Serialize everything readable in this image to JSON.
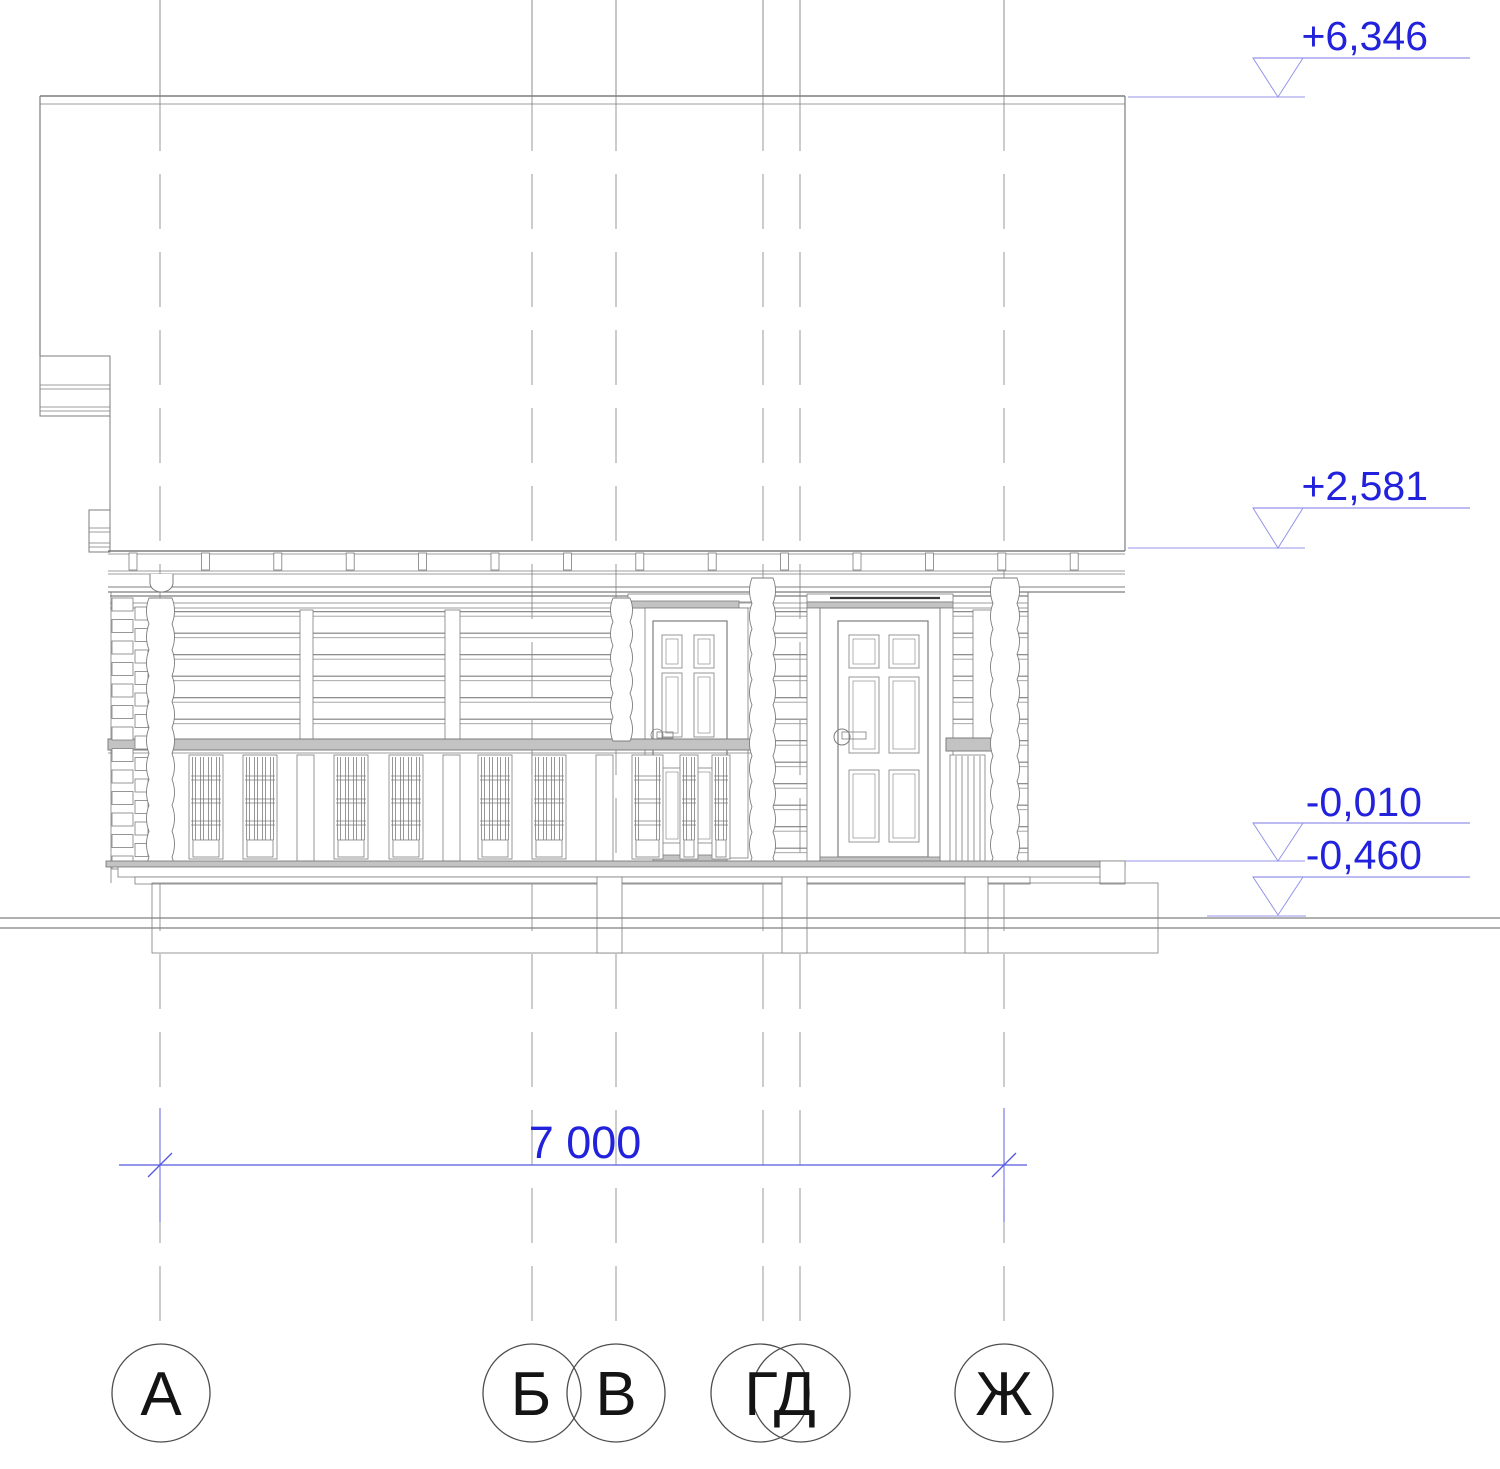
{
  "drawing": {
    "kind": "building facade elevation"
  },
  "elevation_marks": [
    {
      "label": "+6,346"
    },
    {
      "label": "+2,581"
    },
    {
      "label": "-0,010"
    },
    {
      "label": "-0,460"
    }
  ],
  "dimension": {
    "label": "7 000"
  },
  "grid_bubbles": [
    {
      "label": "А"
    },
    {
      "label": "Б"
    },
    {
      "label": "В"
    },
    {
      "label": "ГД"
    },
    {
      "label": "Ж"
    }
  ],
  "colors": {
    "annotation_text": "#2222dd",
    "leader_line": "#9494ea",
    "dimension_line": "#5558e0",
    "drawing_line": "#7d7d7d",
    "light_fill": "#c3c3c3",
    "bubble_stroke": "#4d4d4d",
    "bubble_text": "#141414"
  }
}
